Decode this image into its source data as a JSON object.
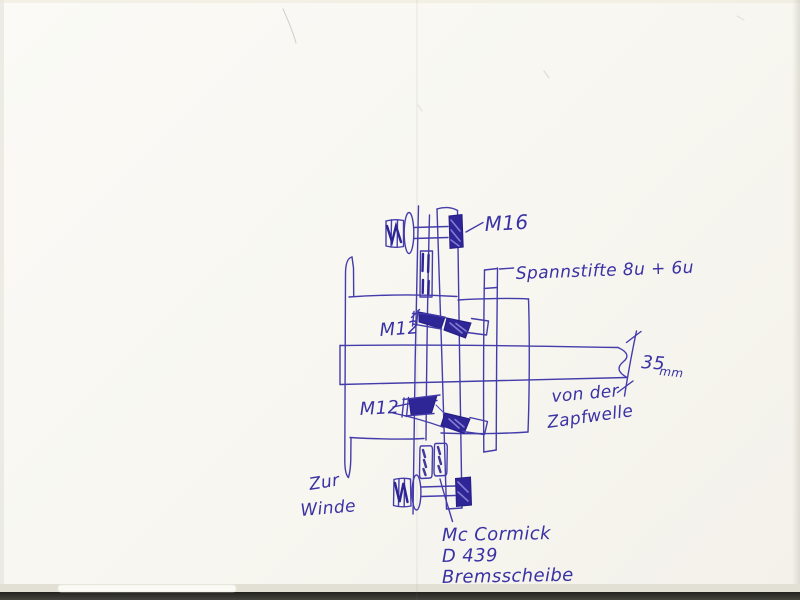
{
  "sketch": {
    "labels": {
      "bolt_top": "M16",
      "pins": "Spannstifte 8u + 6u",
      "bolt_mid_upper": "M12",
      "bolt_mid_lower": "M12",
      "dim_value": "35",
      "dim_unit": "mm",
      "shaft_source_line1": "von der",
      "shaft_source_line2": "Zapfwelle",
      "output_line1": "Zur",
      "output_line2": "Winde",
      "part_line1": "Mc Cormick",
      "part_line2": "D 439",
      "part_line3": "Bremsscheibe"
    },
    "colors": {
      "ink": "#443cab",
      "ink_dark": "#2c2394",
      "paper": "#f8f7f1",
      "bottom_band": "#23231f"
    }
  }
}
